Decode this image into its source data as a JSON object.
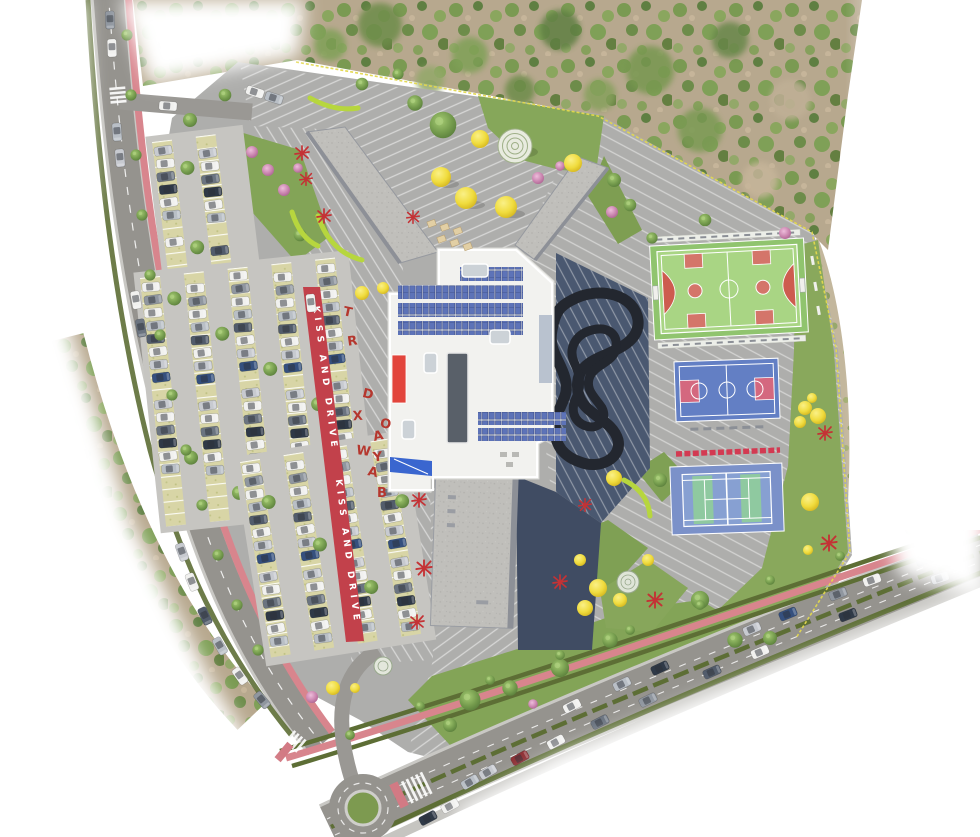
{
  "scene": {
    "description": "Aerial architectural rendering of a school campus site plan with parking, drop-off lane, main building with rooftop solar panels, sports courts, playgrounds and surrounding roads",
    "kind": "site-plan-rendering"
  },
  "labels": {
    "kiss_and_drive": "KISS AND DRIVE"
  },
  "plaza_letters": [
    "T",
    "R",
    "D",
    "X",
    "O",
    "A",
    "W",
    "Y",
    "A",
    "B"
  ],
  "palette": {
    "plaza_gray": "#aeaeac",
    "road_gray": "#95938e",
    "bike_lane_pink": "#d8858d",
    "kiss_lane_red": "#c2414b",
    "letter_red": "#b5372e",
    "roof_white": "#f2f2ef",
    "gravel_roof": "#c0bfbb",
    "solar_panel_blue": "#5d73b8",
    "accent_red": "#e2453c",
    "accent_blue": "#3a66cf",
    "dark_court": "#4a5870",
    "track_black": "#23272f",
    "multi_court_green": "#a9d584",
    "court_key_red": "#d4756a",
    "basketball_blue": "#637fc4",
    "basketball_key_pink": "#d4687f",
    "tennis_blue": "#7b91c9",
    "tennis_panel_green": "#8fc9a0",
    "lawn_green": "#84a457",
    "forest_base": "#b7a88e",
    "hedge_olive": "#5d6e35",
    "ball_yellow": "#f0dc3e",
    "lime_arc": "#b7d63e",
    "play_red": "#c43235",
    "fence_yellow": "#e3d84e"
  },
  "features": [
    "forest",
    "left-road",
    "bottom-road",
    "roundabout",
    "bike-lane",
    "parking-lots",
    "kiss-and-drive-lane",
    "entry-plaza-letters",
    "main-building",
    "solar-panels",
    "skylights",
    "classroom-wings",
    "dark-play-court",
    "pump-track",
    "multi-sport-court",
    "basketball-court",
    "tennis-court",
    "playground",
    "yellow-canopy-spheres",
    "dome-pavilion",
    "lawns"
  ]
}
